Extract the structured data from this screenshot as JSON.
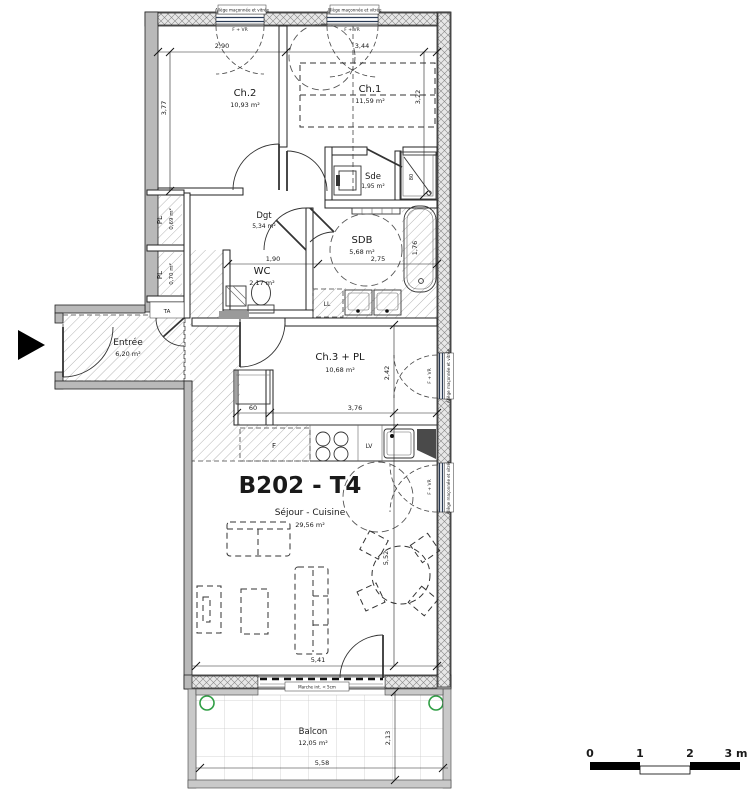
{
  "plan": {
    "title": "B202 - T4",
    "rooms": {
      "ch2": {
        "name": "Ch.2",
        "area": "10,93 m²"
      },
      "ch1": {
        "name": "Ch.1",
        "area": "11,59 m²"
      },
      "sde": {
        "name": "Sde",
        "area": "1,95 m²"
      },
      "sdb": {
        "name": "SDB",
        "area": "5,68 m²"
      },
      "dgt": {
        "name": "Dgt",
        "area": "5,34 m²"
      },
      "wc": {
        "name": "WC",
        "area": "2,17 m²"
      },
      "pl1": {
        "name": "PL",
        "area": "0,69 m²"
      },
      "pl2": {
        "name": "PL",
        "area": "0,70 m²"
      },
      "entree": {
        "name": "Entrée",
        "area": "6,20 m²"
      },
      "ch3": {
        "name": "Ch.3 + PL",
        "area": "10,68 m²"
      },
      "sejour": {
        "name": "Séjour - Cuisine",
        "area": "29,56 m²"
      },
      "balcon": {
        "name": "Balcon",
        "area": "12,05 m²"
      }
    },
    "annotations": {
      "ta": "TA",
      "ll": "LL",
      "lv": "LV",
      "fridge": "F",
      "f_vr": "F + VR",
      "allege": "Allège maçonnée et vitrée",
      "marche": "Marche int. < 5cm",
      "shower_width": "80"
    },
    "dims": {
      "w_ch2": "2,90",
      "w_ch1": "3,44",
      "h_ch2": "3,77",
      "h_ch1": "3,22",
      "w_wc": "1,90",
      "w_sdb": "2,75",
      "tub": "1,76",
      "pl60": "60",
      "w_ch3": "3,76",
      "h_ch3": "2,42",
      "w_sejour": "5,41",
      "h_sejour": "5,52",
      "w_balcon": "5,58",
      "h_balcon": "2,13"
    },
    "scale": {
      "s0": "0",
      "s1": "1",
      "s2": "2",
      "s3": "3 m"
    }
  }
}
